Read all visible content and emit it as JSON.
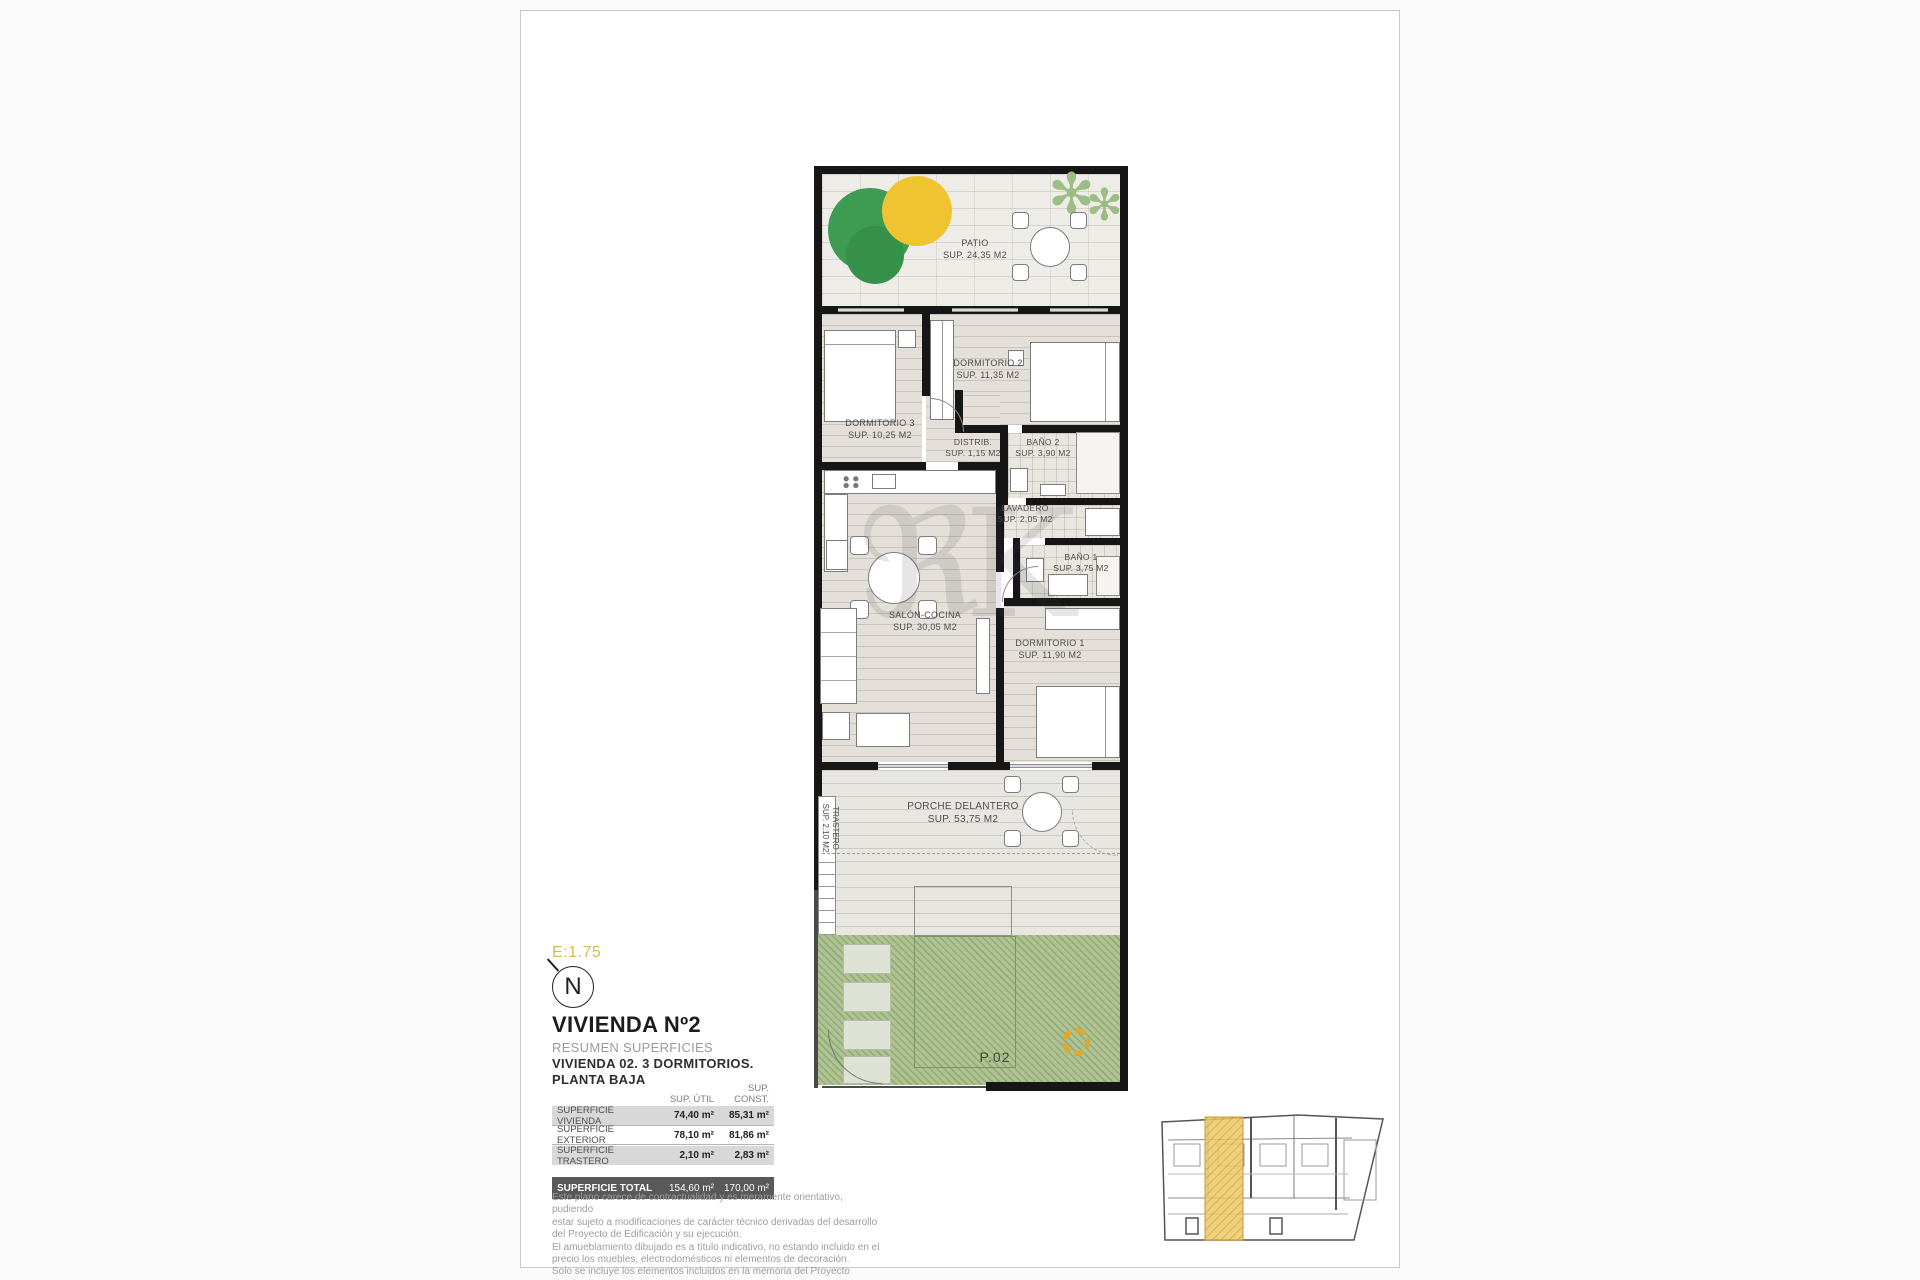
{
  "colors": {
    "accent_gold": "#D9BB4E",
    "keyplan_highlight": "#ECC865",
    "garden_green": "#AEC292",
    "wall_black": "#161616",
    "tree_green": "#3E9B52",
    "tree_yellow": "#F0C431"
  },
  "plan": {
    "watermark": "ℜK",
    "rooms": {
      "patio": {
        "name": "PATIO",
        "sup": "SUP. 24,35 M2"
      },
      "dormitorio2": {
        "name": "DORMITORIO 2",
        "sup": "SUP. 11,35 M2"
      },
      "dormitorio3": {
        "name": "DORMITORIO 3",
        "sup": "SUP. 10,25 M2"
      },
      "distrib": {
        "name": "DISTRIB.",
        "sup": "SUP. 1,15 M2"
      },
      "bano2": {
        "name": "BAÑO 2",
        "sup": "SUP. 3,90 M2"
      },
      "lavadero": {
        "name": "LAVADERO",
        "sup": "SUP. 2,05 M2"
      },
      "bano1": {
        "name": "BAÑO 1",
        "sup": "SUP. 3,75 M2"
      },
      "salon": {
        "name": "SALÓN-COCINA",
        "sup": "SUP. 30,05 M2"
      },
      "dormitorio1": {
        "name": "DORMITORIO 1",
        "sup": "SUP. 11,90 M2"
      },
      "porche": {
        "name": "PORCHE DELANTERO",
        "sup": "SUP. 53,75 M2"
      },
      "trastero": {
        "name": "TRASTERO",
        "sup": "SUP. 2,10 M2"
      },
      "parcela": {
        "name": "P.02"
      }
    }
  },
  "info": {
    "scale": "E:1.75",
    "north": "N",
    "title": "VIVIENDA Nº2",
    "subtitle1": "RESUMEN SUPERFICIES",
    "subtitle2": "VIVIENDA 02. 3 DORMITORIOS.",
    "subtitle3": "PLANTA BAJA"
  },
  "table": {
    "col_util": "SUP. ÚTIL",
    "col_const": "SUP. CONST.",
    "rows": [
      {
        "label": "SUPERFICIE VIVIENDA",
        "util": "74,40 m²",
        "const": "85,31 m²"
      },
      {
        "label": "SUPERFICIE EXTERIOR",
        "util": "78,10 m²",
        "const": "81,86 m²"
      },
      {
        "label": "SUPERFICIE TRASTERO",
        "util": "2,10 m²",
        "const": "2,83 m²"
      }
    ],
    "total": {
      "label": "SUPERFICIE TOTAL",
      "util": "154,60 m²",
      "const": "170,00 m²"
    }
  },
  "disclaimer": [
    "Este plano carece de contractualidad y es meramente orientativo, pudiendo",
    "estar sujeto a modificaciones de carácter técnico derivadas del desarrollo",
    "del Proyecto de Edificación y su ejecución.",
    "El amueblamiento dibujado es a título indicativo, no estando incluido en el",
    "precio los muebles, electrodomésticos ni elementos de decoración.",
    "Solo se incluye los elementos incluidos en la memoria del Proyecto visado."
  ]
}
